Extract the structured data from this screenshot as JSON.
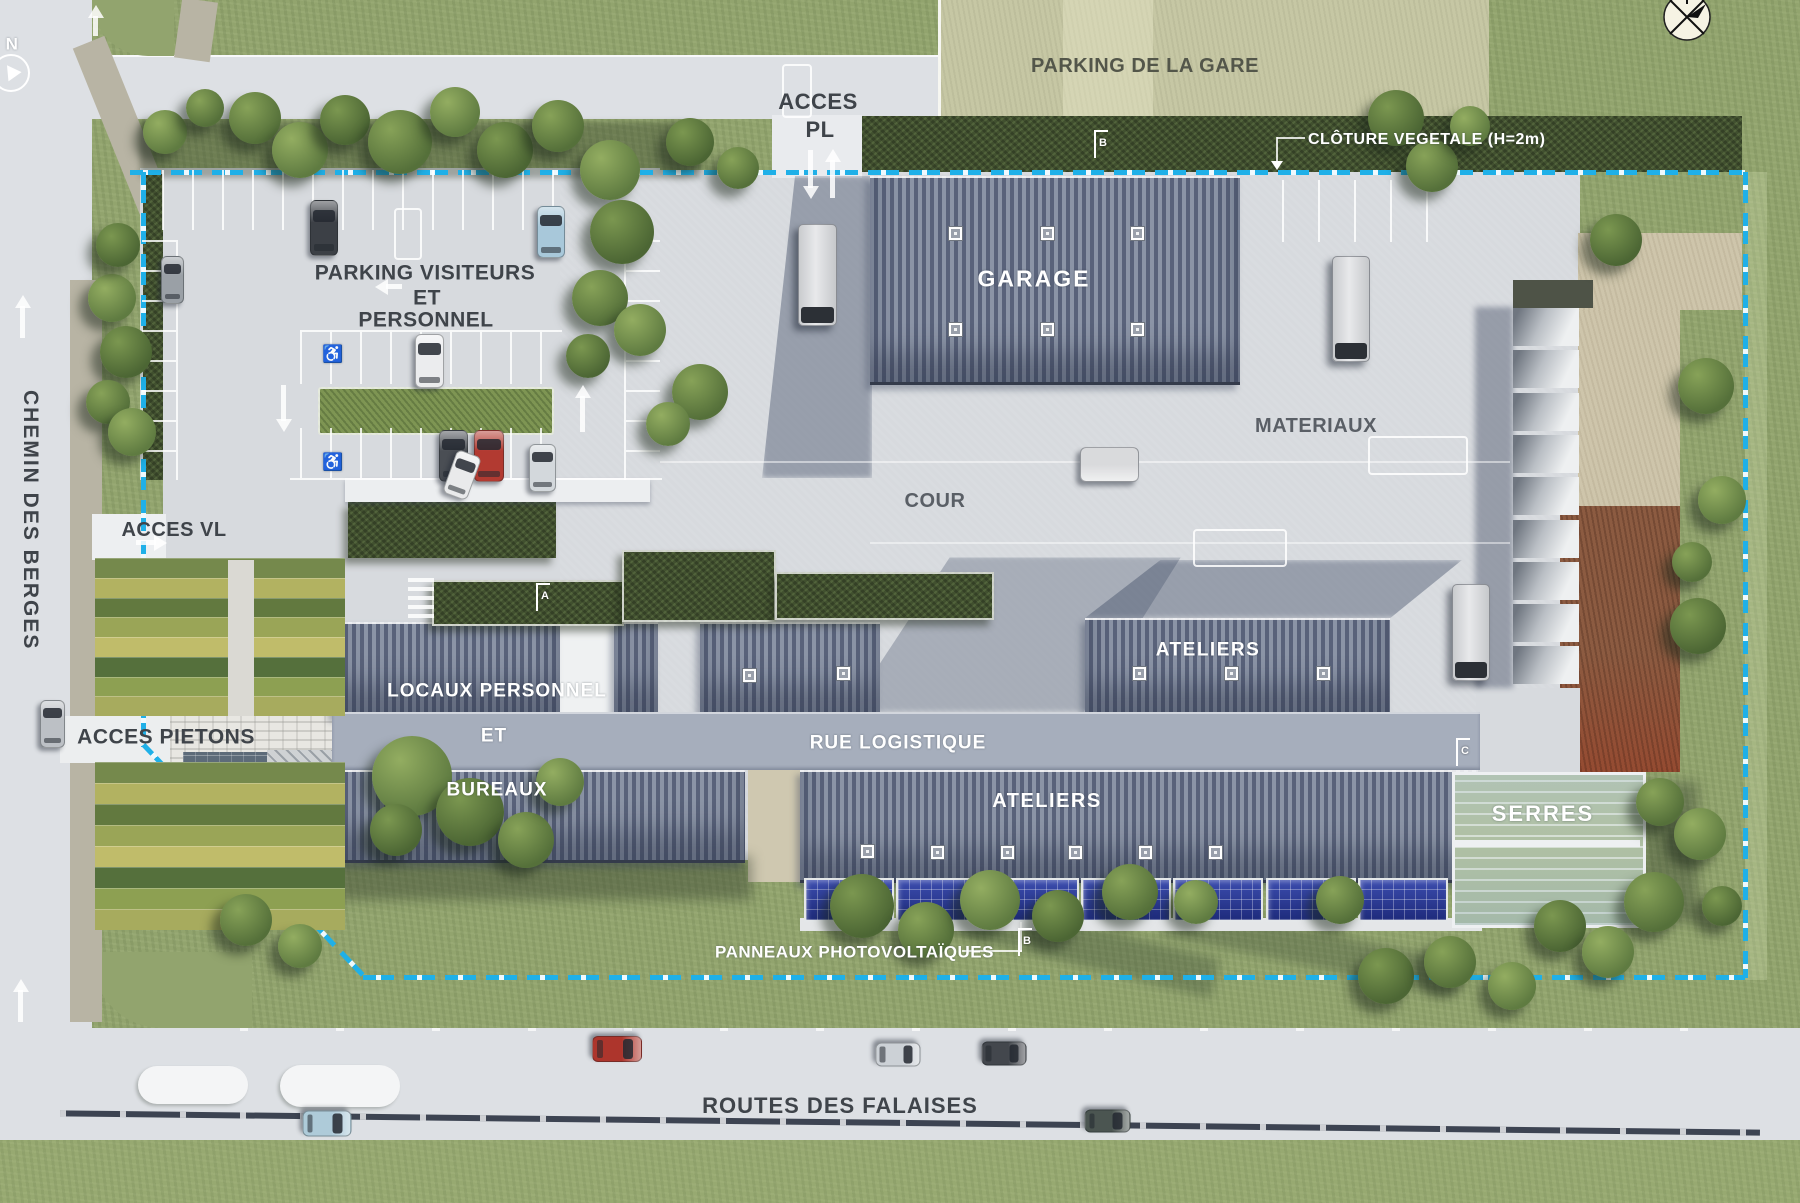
{
  "title": "Plan masse du site",
  "colors": {
    "boundary_cyan": "#1fb0e8",
    "roof_gray": "#6c7689",
    "logistics_band": "#a6aebc",
    "solar_blue": "#2b3b96",
    "grass": "#92a46e",
    "concrete": "#d7dade",
    "parking_gare_beige": "#c6c7a4",
    "gravel_beige": "#cec5ab",
    "dirt_brown": "#8c5b41",
    "label_dark": "#3f444a",
    "label_white": "#ffffff"
  },
  "labels": {
    "parking_gare": "PARKING DE LA GARE",
    "acces_pl_1": "ACCES",
    "acces_pl_2": "PL",
    "cloture": "CLÔTURE VEGETALE (H=2m)",
    "parking_visiteurs_1": "PARKING VISITEURS",
    "parking_visiteurs_2": "ET",
    "parking_visiteurs_3": "PERSONNEL",
    "garage": "GARAGE",
    "materiaux": "MATERIAUX",
    "cour": "COUR",
    "chemin_des_berges": "CHEMIN DES BERGES",
    "acces_vl": "ACCES VL",
    "locaux_personnel": "LOCAUX PERSONNEL",
    "et": "ET",
    "bureaux": "BUREAUX",
    "rue_logistique": "RUE LOGISTIQUE",
    "ateliers_top": "ATELIERS",
    "ateliers_bottom": "ATELIERS",
    "serres": "SERRES",
    "panneaux": "PANNEAUX PHOTOVOLTAÏQUES",
    "routes_des_falaises": "ROUTES DES FALAISES",
    "acces_pietons": "ACCES PIETONS",
    "north": "N"
  },
  "section_markers": {
    "a": "A",
    "b_top": "B",
    "b_bottom": "B",
    "c": "C"
  }
}
